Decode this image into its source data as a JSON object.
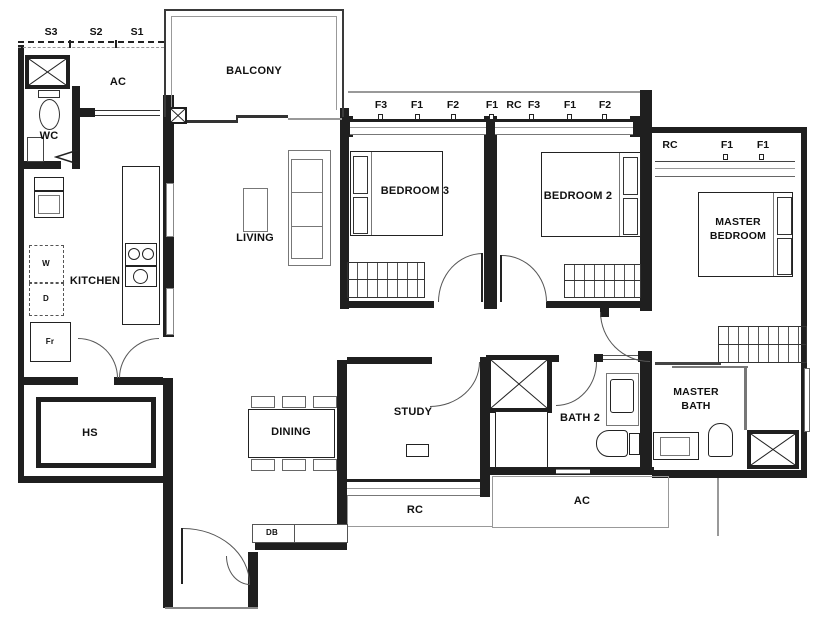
{
  "rooms": {
    "balcony": "BALCONY",
    "ac_upper": "AC",
    "wc": "WC",
    "kitchen": "KITCHEN",
    "living": "LIVING",
    "bedroom3": "BEDROOM 3",
    "bedroom2": "BEDROOM 2",
    "master_bedroom": "MASTER BEDROOM",
    "study": "STUDY",
    "dining": "DINING",
    "bath2": "BATH 2",
    "master_bath": "MASTER BATH",
    "household_shelter": "HS",
    "rc_ledge": "RC",
    "ac_ledge": "AC"
  },
  "fixtures": {
    "washer": "W",
    "dryer": "D",
    "fridge": "Fr",
    "distribution_board": "DB"
  },
  "codes": {
    "s_row": [
      "S3",
      "S2",
      "S1"
    ],
    "bedroom_row": [
      "F3",
      "F1",
      "F2",
      "F1",
      "RC",
      "F3",
      "F1",
      "F2"
    ],
    "master_row": [
      "RC",
      "F1",
      "F1"
    ]
  },
  "colors": {
    "wall": "#1f1f1f",
    "door_swing": "#555555",
    "furniture": "#777777",
    "ledge": "#999999",
    "background": "#ffffff",
    "text": "#111111"
  }
}
